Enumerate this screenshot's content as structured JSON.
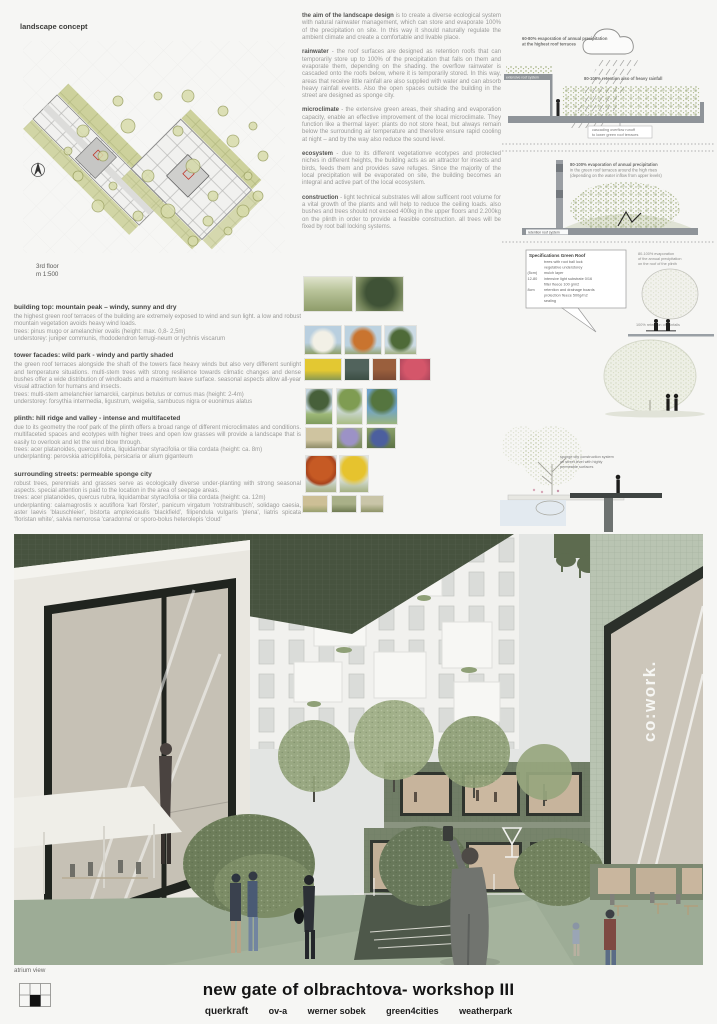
{
  "page": {
    "section_label": "landscape concept",
    "plan_caption_1": "3rd floor",
    "plan_caption_2": "m 1:500",
    "render_caption": "atrium view"
  },
  "mid": {
    "paras": [
      {
        "lead": "the aim of the landscape design",
        "text": " is to create a diverse ecological system with natural rainwater management, which can store and evaporate 100% of the precipitation on site. In this way it should naturally regulate the ambient climate and create a comfortable and livable place."
      },
      {
        "lead": "rainwater",
        "text": " - the roof surfaces are designed as retention roofs that can temporarily store up to 100% of the precipitation that falls on them and evaporate them, depending on the shading. the overflow rainwater is cascaded onto the roofs below, where it is temporarily stored. In this way, areas that receive little rainfall are also supplied with water and can absorb heavy rainfall events. Also the open spaces outside the building in the street are designed as sponge city."
      },
      {
        "lead": "microclimate",
        "text": " - the extensive green areas, their shading and evaporation capacity, enable an effective improvement of the local microclimate. They function like a thermal layer: plants do not store heat, but always remain below the surrounding air temperature and therefore ensure rapid cooling at night – and by the way also reduce the sound level."
      },
      {
        "lead": "ecosystem",
        "text": " - due to its different vegetationve ecotypes and protected niches in different heights, the building acts as an attractor for insects and birds, feeds them and provides save refuges. Since the majority of the local precipitation will be evaporated on site, the building becomes an integral and active part of the local ecosystem."
      },
      {
        "lead": "construction",
        "text": " - light technical substrates will allow sufficent root volume for a vital growth of the plants and will help to reduce the ceiling loads. also bushes and trees should not exceed 400kg in the upper floors and 2.200kg on the plinth in order to provide a feasible construction. all trees will be fixed by root ball locking systems."
      }
    ]
  },
  "left": [
    {
      "heading": "building top: mountain peak – windy, sunny and dry",
      "body": "the highest green roof terraces of the building are extremely exposed to wind and sun light. a low and robust mountain vegetation avoids heavy wind loads.",
      "trees": "trees: pinus mugo or amelanchier ovalis (height: max. 0,8- 2,5m)",
      "under": "understorey: juniper communis, rhododendron ferrugi-neum or lychnis viscarum"
    },
    {
      "heading": "tower facades: wild park - windy and partly shaded",
      "body": "the green roof terraces alongside the shaft of the towers face heavy winds but also very different sunlight and temperature situations. multi-stem trees with strong resilience towards climatic changes and dense bushes offer a wide distribution of windloads and a maximum leave surface. seasonal aspects allow all-year visual attraction for humans and insects.",
      "trees": "trees: multi-stem amelanchier lamarckii, carpinus betulus or cornus mas (height: 2-4m)",
      "under": "understorey: forsythia intermedia, ligustrum, weigelia, sambucus nigra or euonimus alatus"
    },
    {
      "heading": "plinth: hill ridge and valley - intense and multifaceted",
      "body": "due to its geometry the roof park of the plinth offers a broad range of different microclimates and conditions. multifaceted spaces and ecotypes with higher trees and open low grasses will provide a landscape that is easily to overlook and let the wind blow through.",
      "trees": "trees: acer platanoides, quercus rubra, liquidambar styracifolia or tilia cordata (height: ca. 8m)",
      "under": "underplanting: perovskia atriciplifolia, persicaria or alium giganteum"
    },
    {
      "heading": "surrounding streets: permeable sponge city",
      "body": "robust trees, perennials and grasses serve as ecologically diverse under-planting with strong seasonal aspects. special attention is paid to the location in the area of seepage areas.",
      "trees": "trees: acer platanoides, quercus rubra, liquidambar styracifolia or tilia cordata (height: ca. 12m)",
      "under": "underplanting: calamagrostis x acutiflora 'karl förster', panicum virgatum 'rotstrahlbusch', solidago caesia, aster laevis 'blauschleier', bistorta amplexicaulis 'blackfield', filipendula vulgaris 'plena', liatris spicata 'floristan white', salvia nemorosa 'caradonna' or sporo-bolus heterolepis 'cloud'"
    }
  ],
  "right": {
    "labels": {
      "cloud1": "60-80% evaporation of annual precipitation",
      "cloud2": "at the highest roof terraces",
      "ext": "extensive roof system",
      "ret": "80-100% retention also of heavy rainfall",
      "casc1": "cascading overflow runoff",
      "casc2": "to lower green roof terraces",
      "ev21": "80-100% evaporation of annual precipitation",
      "ev22": "in the green roof terraces around the high rises",
      "ev23": "(depending on the water inflow from upper levels)",
      "rrs": "retention roof system",
      "pl1": "80-100% evaporation",
      "pl2": "of the annual precipitation",
      "pl3": "on the roof of the plinth",
      "r100": "100% retention of rainfalls",
      "sp1": "sponge city construction system",
      "sp2": "on street level with highly",
      "sp3": "permeable surfaces"
    },
    "spec": {
      "title": "Specifications Green Roof",
      "dims": [
        "",
        "",
        "(5cm)",
        "12-80",
        "",
        "8cm",
        "",
        ""
      ],
      "rows": [
        "trees with root ball lock",
        "vegetative understorey",
        "mulch layer",
        "intensive light substrate 0/16",
        "filter fleece 100 g/m2",
        "retention and drainage boards",
        "protection fleece 500g/m2",
        "sealing"
      ]
    }
  },
  "render": {
    "sign": "co:work."
  },
  "footer": {
    "title": "new gate of olbrachtova- workshop III",
    "team": [
      "querkraft",
      "ov-a",
      "werner sobek",
      "green4cities",
      "weatherpark"
    ]
  }
}
